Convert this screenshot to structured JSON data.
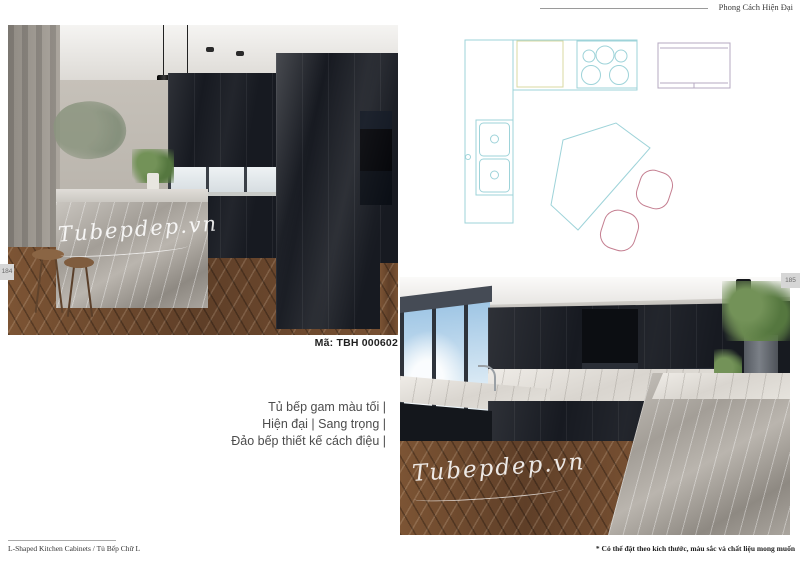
{
  "header": {
    "category_label": "Phong Cách Hiện Đại"
  },
  "page_tabs": {
    "left": "184",
    "right": "185"
  },
  "product": {
    "code": "Mã: TBH 000602",
    "description_line1": "Tủ bếp gam màu tối |",
    "description_line2": "Hiện đại | Sang trọng |",
    "description_line3": "Đảo bếp thiết kế cách điệu |",
    "watermark": "Tubepdep.vn"
  },
  "footer": {
    "left_label": "L-Shaped Kitchen Cabinets / Tủ Bếp Chữ L",
    "right_note": "* Có thể đặt theo kích thước, màu sắc và chất liệu mong muốn"
  },
  "floor_plan": {
    "colors": {
      "counter_line": "#9ed3d9",
      "sink_line": "#d8d8a2",
      "appliance_line": "#b5a8c0",
      "chair_line": "#c47e90"
    }
  }
}
